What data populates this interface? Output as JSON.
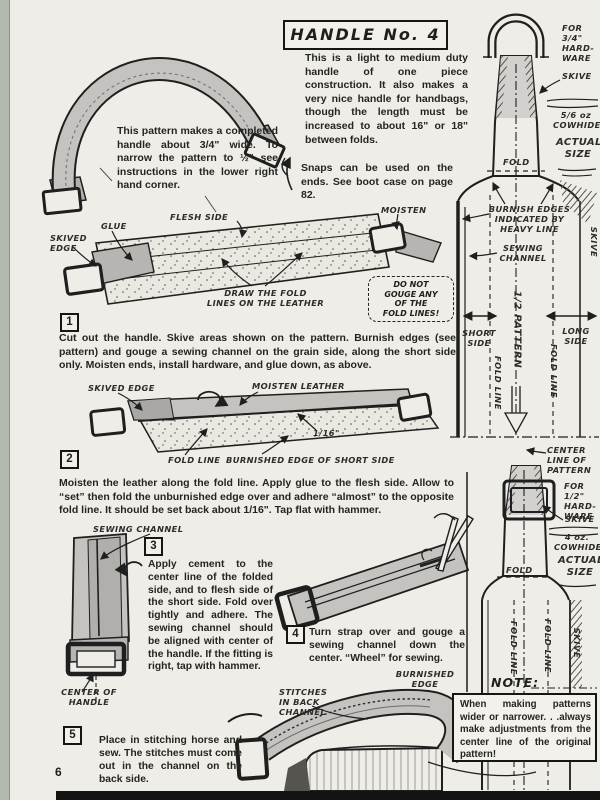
{
  "page": {
    "number": "6"
  },
  "title": {
    "text": "HANDLE No. 4"
  },
  "intro": {
    "text": "This is a light to medium duty handle of one piece construction. It also makes a very nice handle for handbags, though the length must be increased to about 16\" or 18\" between folds."
  },
  "handle_note": {
    "text": "This pattern makes a completed handle about 3/4\" wide. To narrow the pattern to ½\" see instructions in the lower right hand corner."
  },
  "snaps_note": {
    "text": "Snaps can be used on the ends. See boot case on page 82."
  },
  "cut_diagram": {
    "skived_edge": "SKIVED\nEDGE",
    "glue": "GLUE",
    "flesh_side": "FLESH SIDE",
    "moisten": "MOISTEN",
    "draw_fold_lines": "DRAW THE FOLD\nLINES ON THE LEATHER",
    "warning": "DO NOT\nGOUGE ANY\nOF THE\nFOLD LINES!"
  },
  "fold_diagram": {
    "skived_edge": "SKIVED EDGE",
    "moisten_leather": "MOISTEN LEATHER",
    "gap": "1/16\"",
    "fold_line": "FOLD LINE",
    "burnished_edge": "BURNISHED EDGE OF SHORT SIDE"
  },
  "cement_diagram": {
    "sewing_channel": "SEWING CHANNEL",
    "center_of_handle": "CENTER OF\nHANDLE"
  },
  "gouge_diagram": {
    "burnished_edge": "BURNISHED\nEDGE"
  },
  "sew_diagram": {
    "stitches": "STITCHES\nIN BACK\nCHANNEL"
  },
  "steps": [
    {
      "num": "1",
      "text": "Cut out the handle. Skive areas shown on the pattern. Burnish edges (see pattern) and gouge a sewing channel on the grain side, along the short side only. Moisten ends, install hardware, and glue down, as above."
    },
    {
      "num": "2",
      "text": "Moisten the leather along the fold line. Apply glue to the flesh side. Allow to “set” then fold the unburnished edge over and adhere “almost” to the opposite fold line. It should be set back about 1/16\". Tap flat with hammer."
    },
    {
      "num": "3",
      "text": "Apply cement to the center line of the folded side, and to flesh side of the short side. Fold over tightly and adhere. The sewing channel should be aligned with center of the handle. If the fitting is right, tap with hammer."
    },
    {
      "num": "4",
      "text": "Turn strap over and gouge a sewing channel down the center. “Wheel” for sewing."
    },
    {
      "num": "5",
      "text": "Place in stitching horse and sew. The stitches must come out in the channel on the back side."
    }
  ],
  "pattern_top": {
    "hardware": "FOR 3/4\"\nHARD-\nWARE",
    "skive": "SKIVE",
    "leather": "5/6 oz\nCOWHIDE",
    "actual_size": "ACTUAL\nSIZE",
    "fold": "FOLD",
    "burnish": "BURNISH EDGES\nINDICATED BY\nHEAVY LINE",
    "sewing_channel": "SEWING\nCHANNEL",
    "half_pattern": "1/2 PATTERN",
    "short_side": "SHORT\nSIDE",
    "long_side": "LONG\nSIDE",
    "fold_line_left": "FOLD LINE",
    "fold_line_right": "FOLD LINE",
    "skive_edge": "SKIVE",
    "center_line": "CENTER\nLINE OF\nPATTERN"
  },
  "pattern_bottom": {
    "hardware": "FOR 1/2\"\nHARD-\nWARE",
    "skive": "SKIVE",
    "leather": "4 oz.\nCOWHIDE",
    "actual_size": "ACTUAL\nSIZE",
    "fold": "FOLD",
    "fold_line_left": "FOLD LINE",
    "fold_line_right": "FOLD LINE",
    "skive_edge": "SKIVE"
  },
  "note": {
    "label": "NOTE:",
    "text": "When making patterns wider or narrower. . .always make adjustments from the center line of the original pattern!"
  }
}
